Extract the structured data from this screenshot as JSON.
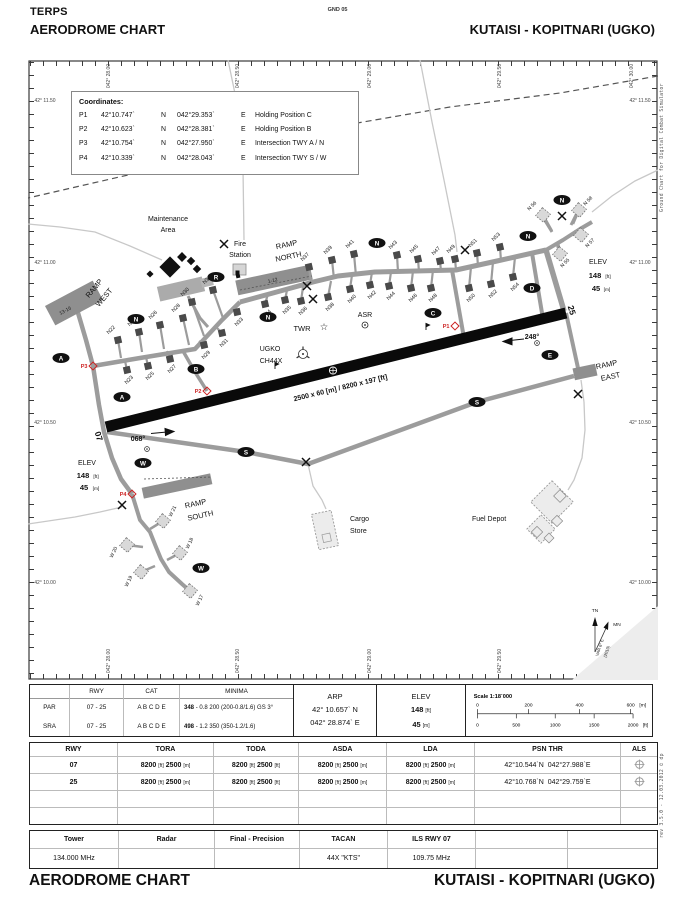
{
  "header": {
    "doc_type": "TERPS",
    "title": "AERODROME CHART",
    "page_ref": "GND 05",
    "airport": "KUTAISI - KOPITNARI (UGKO)"
  },
  "footer": {
    "title": "AERODROME CHART",
    "airport": "KUTAISI - KOPITNARI (UGKO)"
  },
  "side_notes": {
    "right_top": "Ground Chart for Digital Combat Simulator",
    "right_bottom": "rev 3.5.0  -  12.03.2012 © dp"
  },
  "coordinates_box": {
    "title": "Coordinates:",
    "rows": [
      {
        "id": "P1",
        "lat": "42°10.747`",
        "lat_h": "N",
        "lon": "042°29.353`",
        "lon_h": "E",
        "desc": "Holding Position C"
      },
      {
        "id": "P2",
        "lat": "42°10.623`",
        "lat_h": "N",
        "lon": "042°28.381`",
        "lon_h": "E",
        "desc": "Holding Position B"
      },
      {
        "id": "P3",
        "lat": "42°10.754`",
        "lat_h": "N",
        "lon": "042°27.950`",
        "lon_h": "E",
        "desc": "Intersection TWY A / N"
      },
      {
        "id": "P4",
        "lat": "42°10.339`",
        "lat_h": "N",
        "lon": "042°28.043`",
        "lon_h": "E",
        "desc": "Intersection TWY S / W"
      }
    ]
  },
  "map": {
    "grid_top": [
      {
        "t": "042° 28.00",
        "x": 110
      },
      {
        "t": "042° 28.50",
        "x": 239
      },
      {
        "t": "042° 29.00",
        "x": 371
      },
      {
        "t": "042° 29.50",
        "x": 501
      },
      {
        "t": "042° 30.00",
        "x": 633
      }
    ],
    "grid_bottom": [
      {
        "t": "042° 28.00",
        "x": 110
      },
      {
        "t": "042° 28.50",
        "x": 239
      },
      {
        "t": "042° 29.00",
        "x": 371
      },
      {
        "t": "042° 29.50",
        "x": 501
      }
    ],
    "grid_left": [
      {
        "t": "42° 11.50",
        "y": 100
      },
      {
        "t": "42° 11.00",
        "y": 262
      },
      {
        "t": "42° 10.50",
        "y": 422
      },
      {
        "t": "42° 10.00",
        "y": 582
      }
    ],
    "grid_right": [
      {
        "t": "42° 11.50",
        "y": 100
      },
      {
        "t": "42° 11.00",
        "y": 262
      },
      {
        "t": "42° 10.50",
        "y": 422
      },
      {
        "t": "42° 10.00",
        "y": 582
      }
    ],
    "texts": [
      {
        "t": "Maintenance",
        "x": 168,
        "y": 221,
        "s": 7
      },
      {
        "t": "Area",
        "x": 168,
        "y": 232,
        "s": 7
      },
      {
        "t": "Fire",
        "x": 240,
        "y": 246,
        "s": 7
      },
      {
        "t": "Station",
        "x": 240,
        "y": 257,
        "s": 7
      },
      {
        "t": "RAMP",
        "x": 287,
        "y": 247,
        "s": 7.5,
        "r": -12
      },
      {
        "t": "NORTH",
        "x": 289,
        "y": 259,
        "s": 7.5,
        "r": -12
      },
      {
        "t": "RAMP",
        "x": 96,
        "y": 290,
        "s": 7.5,
        "r": -50
      },
      {
        "t": "WEST",
        "x": 106,
        "y": 299,
        "s": 7.5,
        "r": -50
      },
      {
        "t": "13-16",
        "x": 66,
        "y": 312,
        "s": 5,
        "r": -28,
        "c": "#222"
      },
      {
        "t": "1-12",
        "x": 273,
        "y": 282,
        "s": 5,
        "r": -12,
        "c": "#222"
      },
      {
        "t": "TWR",
        "x": 302,
        "y": 331,
        "s": 7.5
      },
      {
        "t": "ASR",
        "x": 365,
        "y": 317,
        "s": 7
      },
      {
        "t": "UGKO",
        "x": 270,
        "y": 351,
        "s": 7
      },
      {
        "t": "CH44X",
        "x": 271,
        "y": 363,
        "s": 7
      },
      {
        "t": "068°",
        "x": 138,
        "y": 441,
        "s": 7,
        "b": 1
      },
      {
        "t": "248°",
        "x": 532,
        "y": 339,
        "s": 7,
        "b": 1
      },
      {
        "t": "07",
        "x": 96,
        "y": 437,
        "s": 8.5,
        "b": 1,
        "r": 73
      },
      {
        "t": "25",
        "x": 569,
        "y": 311,
        "s": 8.5,
        "b": 1,
        "r": 73
      },
      {
        "t": "2500 x 60 [m] / 8200 x 197 [ft]",
        "x": 341,
        "y": 390,
        "s": 7,
        "b": 1,
        "r": -13.5
      },
      {
        "t": "ELEV",
        "x": 87,
        "y": 465,
        "s": 7
      },
      {
        "t": "148",
        "x": 83,
        "y": 478,
        "s": 7.5,
        "b": 1
      },
      {
        "t": "[ft]",
        "x": 96,
        "y": 478,
        "s": 4.8
      },
      {
        "t": "45",
        "x": 84,
        "y": 490,
        "s": 7.5,
        "b": 1
      },
      {
        "t": "[m]",
        "x": 96,
        "y": 490,
        "s": 4.8
      },
      {
        "t": "ELEV",
        "x": 598,
        "y": 264,
        "s": 7
      },
      {
        "t": "148",
        "x": 595,
        "y": 278,
        "s": 7.5,
        "b": 1
      },
      {
        "t": "[ft]",
        "x": 608,
        "y": 278,
        "s": 4.8
      },
      {
        "t": "45",
        "x": 596,
        "y": 291,
        "s": 7.5,
        "b": 1
      },
      {
        "t": "[m]",
        "x": 607,
        "y": 291,
        "s": 4.8
      },
      {
        "t": "RAMP",
        "x": 196,
        "y": 506,
        "s": 7.5,
        "r": -12
      },
      {
        "t": "SOUTH",
        "x": 201,
        "y": 518,
        "s": 7.5,
        "r": -12
      },
      {
        "t": "RAMP",
        "x": 607,
        "y": 367,
        "s": 7.5,
        "r": -12
      },
      {
        "t": "EAST",
        "x": 611,
        "y": 379,
        "s": 7.5,
        "r": -12
      },
      {
        "t": "Cargo",
        "x": 350,
        "y": 521,
        "s": 7,
        "a": "start"
      },
      {
        "t": "Store",
        "x": 350,
        "y": 533,
        "s": 7,
        "a": "start"
      },
      {
        "t": "Fuel Depot",
        "x": 472,
        "y": 521,
        "s": 7,
        "a": "start"
      },
      {
        "t": "TN",
        "x": 595,
        "y": 612,
        "s": 4.8
      },
      {
        "t": "MN",
        "x": 617,
        "y": 626,
        "s": 4.8
      },
      {
        "t": "VAR 6° E",
        "x": 601,
        "y": 648,
        "s": 4.2,
        "r": -72
      },
      {
        "t": "(2010)",
        "x": 608,
        "y": 652,
        "s": 4.2,
        "r": -72
      }
    ],
    "badges": [
      {
        "t": "A",
        "x": 61,
        "y": 358
      },
      {
        "t": "A",
        "x": 122,
        "y": 397
      },
      {
        "t": "B",
        "x": 196,
        "y": 369
      },
      {
        "t": "C",
        "x": 433,
        "y": 313
      },
      {
        "t": "D",
        "x": 532,
        "y": 288
      },
      {
        "t": "E",
        "x": 550,
        "y": 355
      },
      {
        "t": "N",
        "x": 136,
        "y": 319
      },
      {
        "t": "N",
        "x": 268,
        "y": 317
      },
      {
        "t": "N",
        "x": 377,
        "y": 243
      },
      {
        "t": "N",
        "x": 528,
        "y": 236
      },
      {
        "t": "N",
        "x": 562,
        "y": 200
      },
      {
        "t": "R",
        "x": 216,
        "y": 277
      },
      {
        "t": "S",
        "x": 246,
        "y": 452
      },
      {
        "t": "S",
        "x": 477,
        "y": 402
      },
      {
        "t": "W",
        "x": 143,
        "y": 463
      },
      {
        "t": "W",
        "x": 201,
        "y": 568
      }
    ],
    "holding_points": [
      {
        "t": "P1",
        "x": 455,
        "y": 326
      },
      {
        "t": "P2",
        "x": 207,
        "y": 391
      },
      {
        "t": "P3",
        "x": 93,
        "y": 366
      },
      {
        "t": "P4",
        "x": 132,
        "y": 494
      }
    ],
    "closed_marks": [
      {
        "x": 224,
        "y": 244
      },
      {
        "x": 307,
        "y": 286
      },
      {
        "x": 313,
        "y": 299
      },
      {
        "x": 465,
        "y": 250
      },
      {
        "x": 562,
        "y": 216
      },
      {
        "x": 578,
        "y": 394
      },
      {
        "x": 306,
        "y": 462
      },
      {
        "x": 122,
        "y": 505
      }
    ],
    "stands": [
      {
        "t": "N22",
        "x": 118,
        "y": 340,
        "sx": 121,
        "sy": 358,
        "lx": 112,
        "ly": 331
      },
      {
        "t": "N24",
        "x": 139,
        "y": 332,
        "sx": 142,
        "sy": 352,
        "lx": 133,
        "ly": 323
      },
      {
        "t": "N26",
        "x": 160,
        "y": 325,
        "sx": 164,
        "sy": 349,
        "lx": 154,
        "ly": 316
      },
      {
        "t": "N28",
        "x": 183,
        "y": 318,
        "sx": 189,
        "sy": 345,
        "lx": 177,
        "ly": 309
      },
      {
        "t": "N30",
        "x": 192,
        "y": 302,
        "sx": 204,
        "sy": 336,
        "lx": 186,
        "ly": 293
      },
      {
        "t": "N32",
        "x": 213,
        "y": 290,
        "sx": 223,
        "sy": 318,
        "lx": 208,
        "ly": 281
      },
      {
        "t": "N23",
        "x": 127,
        "y": 370,
        "sx": 125,
        "sy": 361,
        "lx": 130,
        "ly": 381
      },
      {
        "t": "N25",
        "x": 148,
        "y": 366,
        "sx": 146,
        "sy": 357,
        "lx": 151,
        "ly": 377
      },
      {
        "t": "N27",
        "x": 170,
        "y": 359,
        "sx": 167,
        "sy": 351,
        "lx": 173,
        "ly": 370
      },
      {
        "t": "N29",
        "x": 204,
        "y": 345,
        "sx": 199,
        "sy": 341,
        "lx": 207,
        "ly": 356
      },
      {
        "t": "N31",
        "x": 222,
        "y": 333,
        "sx": 217,
        "sy": 328,
        "lx": 225,
        "ly": 344
      },
      {
        "t": "N33",
        "x": 237,
        "y": 312,
        "sx": 232,
        "sy": 307,
        "lx": 240,
        "ly": 323
      },
      {
        "t": "N34",
        "x": 265,
        "y": 304,
        "sx": 268,
        "sy": 294,
        "lx": 268,
        "ly": 315
      },
      {
        "t": "N35",
        "x": 285,
        "y": 300,
        "sx": 287,
        "sy": 290,
        "lx": 288,
        "ly": 311
      },
      {
        "t": "N36",
        "x": 301,
        "y": 301,
        "sx": 303,
        "sy": 287,
        "lx": 304,
        "ly": 312
      },
      {
        "t": "N38",
        "x": 328,
        "y": 297,
        "sx": 331,
        "sy": 281,
        "lx": 331,
        "ly": 308
      },
      {
        "t": "N40",
        "x": 350,
        "y": 289,
        "sx": 352,
        "sy": 275,
        "lx": 353,
        "ly": 300
      },
      {
        "t": "N42",
        "x": 370,
        "y": 285,
        "sx": 372,
        "sy": 272,
        "lx": 373,
        "ly": 296
      },
      {
        "t": "N44",
        "x": 389,
        "y": 286,
        "sx": 391,
        "sy": 272,
        "lx": 392,
        "ly": 297
      },
      {
        "t": "N46",
        "x": 411,
        "y": 288,
        "sx": 413,
        "sy": 271,
        "lx": 414,
        "ly": 299
      },
      {
        "t": "N48",
        "x": 431,
        "y": 288,
        "sx": 433,
        "sy": 270,
        "lx": 434,
        "ly": 299
      },
      {
        "t": "N50",
        "x": 469,
        "y": 288,
        "sx": 471,
        "sy": 267,
        "lx": 472,
        "ly": 299
      },
      {
        "t": "N52",
        "x": 491,
        "y": 284,
        "sx": 493,
        "sy": 262,
        "lx": 494,
        "ly": 295
      },
      {
        "t": "N54",
        "x": 513,
        "y": 277,
        "sx": 515,
        "sy": 257,
        "lx": 516,
        "ly": 288
      },
      {
        "t": "N37",
        "x": 309,
        "y": 267,
        "sx": 311,
        "sy": 283,
        "lx": 306,
        "ly": 258
      },
      {
        "t": "N39",
        "x": 332,
        "y": 260,
        "sx": 334,
        "sy": 279,
        "lx": 329,
        "ly": 251
      },
      {
        "t": "N41",
        "x": 354,
        "y": 254,
        "sx": 356,
        "sy": 276,
        "lx": 351,
        "ly": 245
      },
      {
        "t": "N43",
        "x": 397,
        "y": 255,
        "sx": 398,
        "sy": 272,
        "lx": 394,
        "ly": 246
      },
      {
        "t": "N45",
        "x": 418,
        "y": 259,
        "sx": 419,
        "sy": 272,
        "lx": 415,
        "ly": 250
      },
      {
        "t": "N47",
        "x": 440,
        "y": 261,
        "sx": 441,
        "sy": 271,
        "lx": 437,
        "ly": 252
      },
      {
        "t": "N49",
        "x": 455,
        "y": 259,
        "sx": 456,
        "sy": 270,
        "lx": 452,
        "ly": 250
      },
      {
        "t": "N51",
        "x": 477,
        "y": 253,
        "sx": 478,
        "sy": 266,
        "lx": 474,
        "ly": 244
      },
      {
        "t": "N53",
        "x": 500,
        "y": 247,
        "sx": 501,
        "sy": 261,
        "lx": 497,
        "ly": 238
      }
    ],
    "dashed_stands": [
      {
        "t": "N 56",
        "x": 543,
        "y": 215,
        "sx": 552,
        "sy": 231,
        "lx": 533,
        "ly": 207,
        "lr": -45
      },
      {
        "t": "N 58",
        "x": 579,
        "y": 210,
        "sx": 573,
        "sy": 224,
        "lx": 589,
        "ly": 202,
        "lr": -45
      },
      {
        "t": "N 57",
        "x": 581,
        "y": 235,
        "sx": 574,
        "sy": 231,
        "lx": 591,
        "ly": 244,
        "lr": -45
      },
      {
        "t": "N 55",
        "x": 560,
        "y": 254,
        "sx": 558,
        "sy": 242,
        "lx": 566,
        "ly": 264,
        "lr": -45
      },
      {
        "t": "W 21",
        "x": 163,
        "y": 521,
        "sx": 150,
        "sy": 529,
        "lx": 174,
        "ly": 512,
        "lr": -65
      },
      {
        "t": "W 20",
        "x": 127,
        "y": 545,
        "sx": 143,
        "sy": 547,
        "lx": 115,
        "ly": 553,
        "lr": -65
      },
      {
        "t": "W 19",
        "x": 141,
        "y": 572,
        "sx": 155,
        "sy": 566,
        "lx": 130,
        "ly": 582,
        "lr": -65
      },
      {
        "t": "W 18",
        "x": 180,
        "y": 553,
        "sx": 167,
        "sy": 560,
        "lx": 191,
        "ly": 544,
        "lr": -65
      },
      {
        "t": "W 17",
        "x": 190,
        "y": 591,
        "sx": 185,
        "sy": 586,
        "lx": 201,
        "ly": 601,
        "lr": -65
      }
    ]
  },
  "minima": {
    "headers": [
      "",
      "RWY",
      "CAT",
      "MINIMA"
    ],
    "rows": [
      {
        "id": "PAR",
        "rwy": "07 - 25",
        "cat": "A B C D E",
        "val_bold": "348",
        "val_rest": "- 0.8 200 (200-0.8/1.6) GS 3°"
      },
      {
        "id": "SRA",
        "rwy": "07 - 25",
        "cat": "A B C D E",
        "val_bold": "498",
        "val_rest": "- 1.2 350 (350-1.2/1.6)"
      }
    ]
  },
  "arp": {
    "label": "ARP",
    "lat": "42° 10.657` N",
    "lon": "042° 28.874` E"
  },
  "elev": {
    "label": "ELEV",
    "ft": "148",
    "ft_unit": "[ft]",
    "m": "45",
    "m_unit": "[m]"
  },
  "scale": {
    "label": "Scale 1:18`000",
    "m_ticks": [
      "0",
      "200",
      "400",
      "600"
    ],
    "m_unit": "[m]",
    "ft_ticks": [
      "0",
      "500",
      "1000",
      "1500",
      "2000"
    ],
    "ft_unit": "[ft]"
  },
  "runway_table": {
    "headers": [
      "RWY",
      "TORA",
      "TODA",
      "ASDA",
      "LDA",
      "PSN THR",
      "ALS"
    ],
    "rows": [
      {
        "rwy": "07",
        "tora": {
          "v1": "8200",
          "u1": "[ft]",
          "v2": "2500",
          "u2": "[m]"
        },
        "toda": {
          "v1": "8200",
          "u1": "[ft]",
          "v2": "2500",
          "u2": "[ft]"
        },
        "asda": {
          "v1": "8200",
          "u1": "[ft]",
          "v2": "2500",
          "u2": "[m]"
        },
        "lda": {
          "v1": "8200",
          "u1": "[ft]",
          "v2": "2500",
          "u2": "[m]"
        },
        "psn_lat": "42°10.544`N",
        "psn_lon": "042°27.988`E"
      },
      {
        "rwy": "25",
        "tora": {
          "v1": "8200",
          "u1": "[ft]",
          "v2": "2500",
          "u2": "[m]"
        },
        "toda": {
          "v1": "8200",
          "u1": "[ft]",
          "v2": "2500",
          "u2": "[ft]"
        },
        "asda": {
          "v1": "8200",
          "u1": "[ft]",
          "v2": "2500",
          "u2": "[m]"
        },
        "lda": {
          "v1": "8200",
          "u1": "[ft]",
          "v2": "2500",
          "u2": "[m]"
        },
        "psn_lat": "42°10.768`N",
        "psn_lon": "042°29.759`E"
      }
    ]
  },
  "comms": {
    "headers": [
      "Tower",
      "Radar",
      "Final - Precision",
      "TACAN",
      "ILS RWY 07",
      "",
      ""
    ],
    "values": [
      "134.000 MHz",
      "",
      "",
      "44X \"KTS\"",
      "109.75 MHz",
      "",
      ""
    ]
  }
}
